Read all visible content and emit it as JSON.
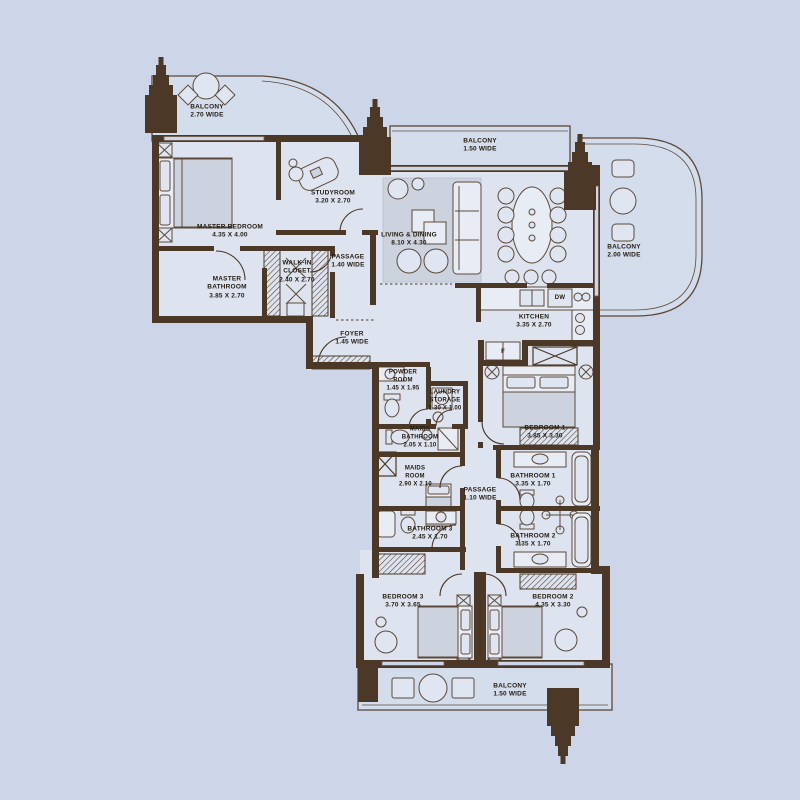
{
  "plan": {
    "type": "apartment-floor-plan",
    "colors": {
      "background": "#ccd6e8",
      "wall": "#4b3827",
      "floor": "#dde4f0",
      "balcony_floor": "#d4ddec",
      "furniture_gray": "#ccd3de",
      "label_text": "#241c12"
    }
  },
  "rooms": {
    "balcony_top_left": {
      "name": "BALCONY",
      "dims": "2.70 WIDE"
    },
    "master_bedroom": {
      "name": "MASTER BEDROOM",
      "dims": "4.35 x 4.00"
    },
    "studyroom": {
      "name": "STUDYROOM",
      "dims": "3.20 x 2.70"
    },
    "master_bathroom": {
      "name": "MASTER BATHROOM",
      "dims": "3.85 x 2.70"
    },
    "walk_in_closet": {
      "name": "WALK-IN CLOSET",
      "dims": "2.40 x 2.70"
    },
    "passage_1": {
      "name": "PASSAGE",
      "dims": "1.40 WIDE"
    },
    "balcony_top": {
      "name": "BALCONY",
      "dims": "1.50 WIDE"
    },
    "living_dining": {
      "name": "LIVING & DINING",
      "dims": "8.10 x 4.30"
    },
    "balcony_right": {
      "name": "BALCONY",
      "dims": "2.00 WIDE"
    },
    "kitchen": {
      "name": "KITCHEN",
      "dims": "3.35 x 2.70"
    },
    "foyer": {
      "name": "FOYER",
      "dims": "1.45 WIDE"
    },
    "powder_room": {
      "name": "POWDER ROOM",
      "dims": "1.45 x 1.95"
    },
    "laundry_storage": {
      "name": "LAUNDRY STORAGE",
      "dims": "1.30 x 1.00"
    },
    "maids_bathroom": {
      "name": "MAIDS BATHROOM",
      "dims": "2.05 x 1.10"
    },
    "maids_room": {
      "name": "MAIDS ROOM",
      "dims": "2.90 x 2.10"
    },
    "bedroom_1": {
      "name": "BEDROOM 1",
      "dims": "3.85 x 3.30"
    },
    "passage_2": {
      "name": "PASSAGE",
      "dims": "1.10 WIDE"
    },
    "bathroom_1": {
      "name": "BATHROOM 1",
      "dims": "3.35 x 1.70"
    },
    "bathroom_2": {
      "name": "BATHROOM 2",
      "dims": "3.35 x 1.70"
    },
    "bathroom_3": {
      "name": "BATHROOM 3",
      "dims": "2.45 x 1.70"
    },
    "bedroom_3": {
      "name": "BEDROOM 3",
      "dims": "3.70 x 3.65"
    },
    "bedroom_2": {
      "name": "BEDROOM 2",
      "dims": "4.35 x 3.30"
    },
    "balcony_bottom": {
      "name": "BALCONY",
      "dims": "1.50 WIDE"
    }
  },
  "appliances": {
    "dishwasher": "DW",
    "fridge": "F"
  }
}
